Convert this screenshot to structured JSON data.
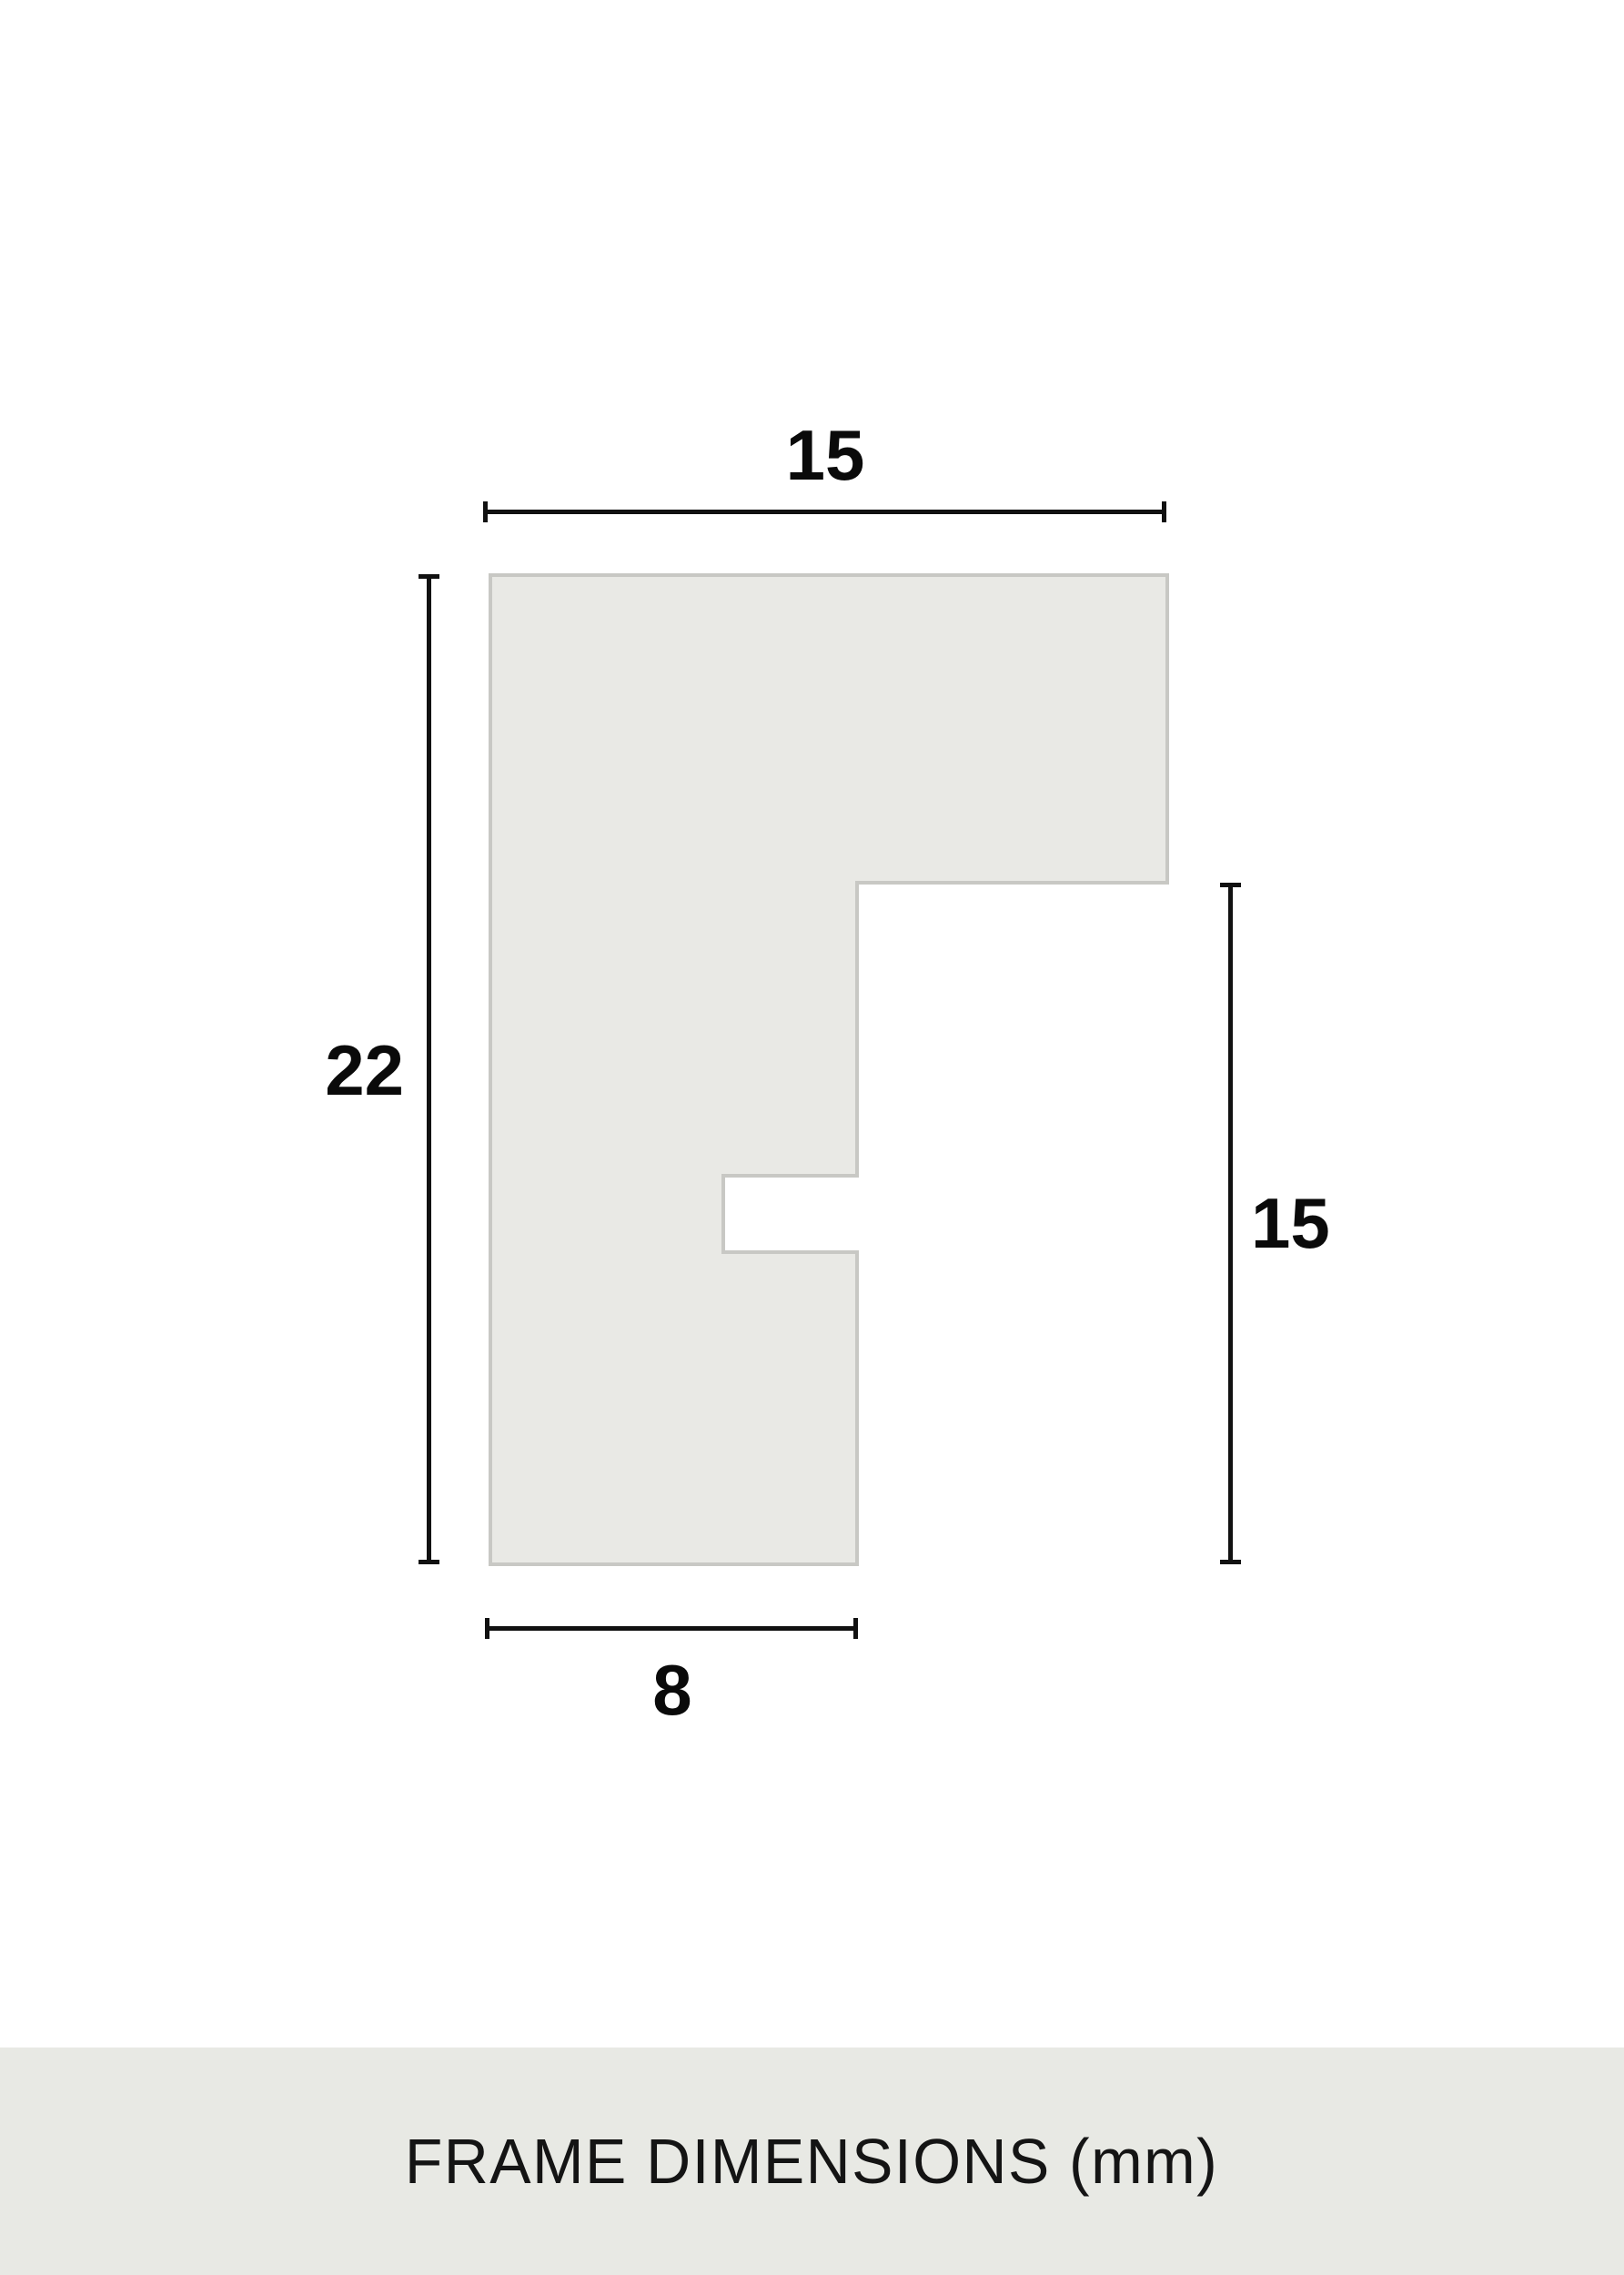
{
  "diagram": {
    "type": "frame-profile-cross-section",
    "labels": {
      "top_width": "15",
      "left_height": "22",
      "right_height": "15",
      "bottom_width": "8"
    },
    "values_mm": {
      "top_width": 15,
      "overall_height": 22,
      "right_side_height": 15,
      "bottom_width": 8
    },
    "unit": "mm",
    "colors": {
      "background": "#ffffff",
      "profile_fill": "#e9e9e5",
      "profile_border": "#c8c8c4",
      "dimension_line": "#111111",
      "label_text": "#0a0a0a",
      "footer_background": "#e8e9e4",
      "footer_text": "#141414"
    }
  },
  "footer": {
    "title": "FRAME DIMENSIONS (mm)"
  }
}
